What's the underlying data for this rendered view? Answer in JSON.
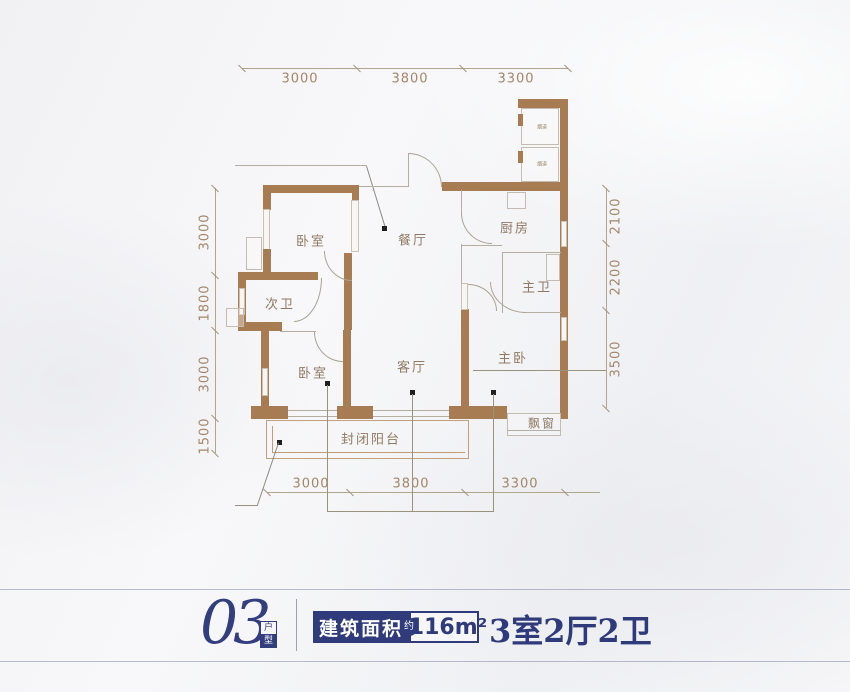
{
  "plan": {
    "rooms": {
      "bedroom_top": "卧室",
      "dining": "餐厅",
      "kitchen": "厨房",
      "bathroom_second": "次卫",
      "bathroom_master": "主卫",
      "living": "客厅",
      "bedroom_master": "主卧",
      "bedroom_bottom": "卧室",
      "balcony": "封闭阳台",
      "bay_window": "飘窗"
    },
    "shaft_labels": {
      "top": "烟道",
      "bottom": "烟道"
    },
    "dims": {
      "top": [
        "3000",
        "3800",
        "3300"
      ],
      "bottom": [
        "3000",
        "3800",
        "3300"
      ],
      "left": [
        "3000",
        "1800",
        "3000",
        "1500"
      ],
      "right": [
        "2100",
        "2200",
        "3500"
      ]
    }
  },
  "footer": {
    "unit_number": "03",
    "unit_badge": {
      "top": "户",
      "bottom": "型"
    },
    "area_label": "建筑面积",
    "area_prefix": "约",
    "area_value": "116m²",
    "rooms_summary": "3室2厅2卫"
  },
  "colors": {
    "wall": "#a87c52",
    "navy": "#303b7c",
    "dimension_text": "#a3866a",
    "room_text": "#8f7963"
  }
}
